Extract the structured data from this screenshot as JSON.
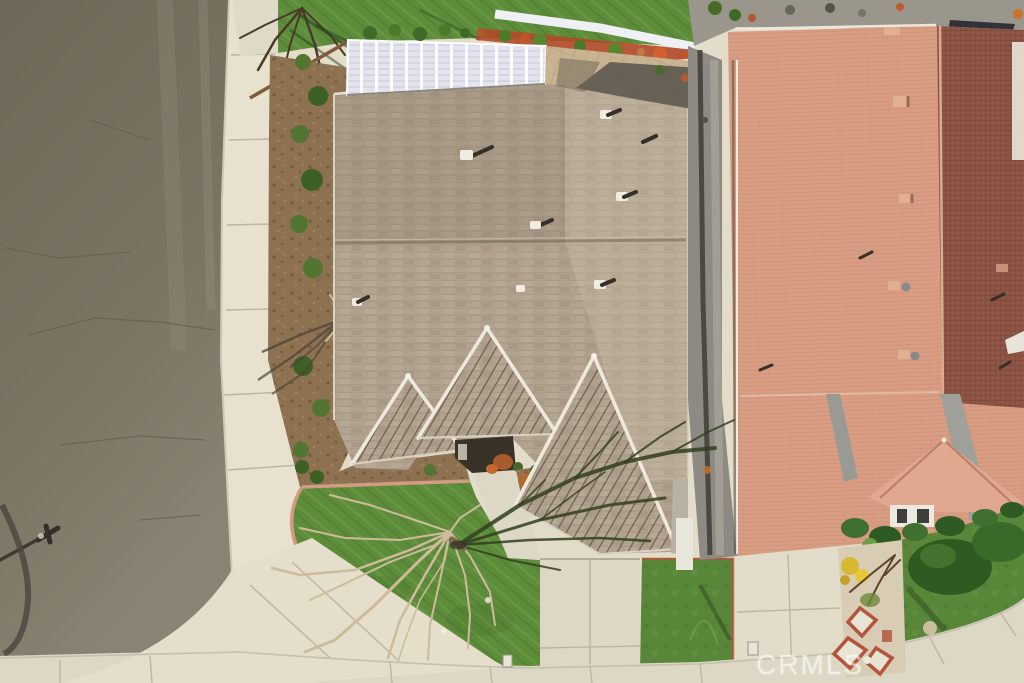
{
  "watermark": {
    "text": "CRMLS"
  },
  "palette": {
    "road": "#77715f",
    "concrete": "#e2dcc9",
    "mulch": "#8d7150",
    "grass": "#5d8c3a",
    "roof_tan": "#b0a28e",
    "roof_salmon": "#d89d83",
    "roof_salmon_shaded": "#8f5646",
    "white_trim": "#eef0f3",
    "brick_red": "#b5543c",
    "back_mulch_red": "#b04a28",
    "watermark_white": "#ffffff"
  },
  "scene": {
    "type": "aerial-drone-photo",
    "elements": [
      "asphalt-street-left",
      "concrete-sidewalk",
      "corner-lot",
      "gray-shingle-roof-house-center",
      "front-gables",
      "white-pergola-backyard",
      "paver-patio",
      "white-vinyl-fence",
      "red-mulch-planter",
      "bare-tree-front-lawn",
      "tree-shadow",
      "green-lawns",
      "mulch-bed-with-shrubs",
      "brick-edged-walkway",
      "terracotta-tile-roof-house-right",
      "driveways",
      "streetlight-shadow"
    ]
  }
}
